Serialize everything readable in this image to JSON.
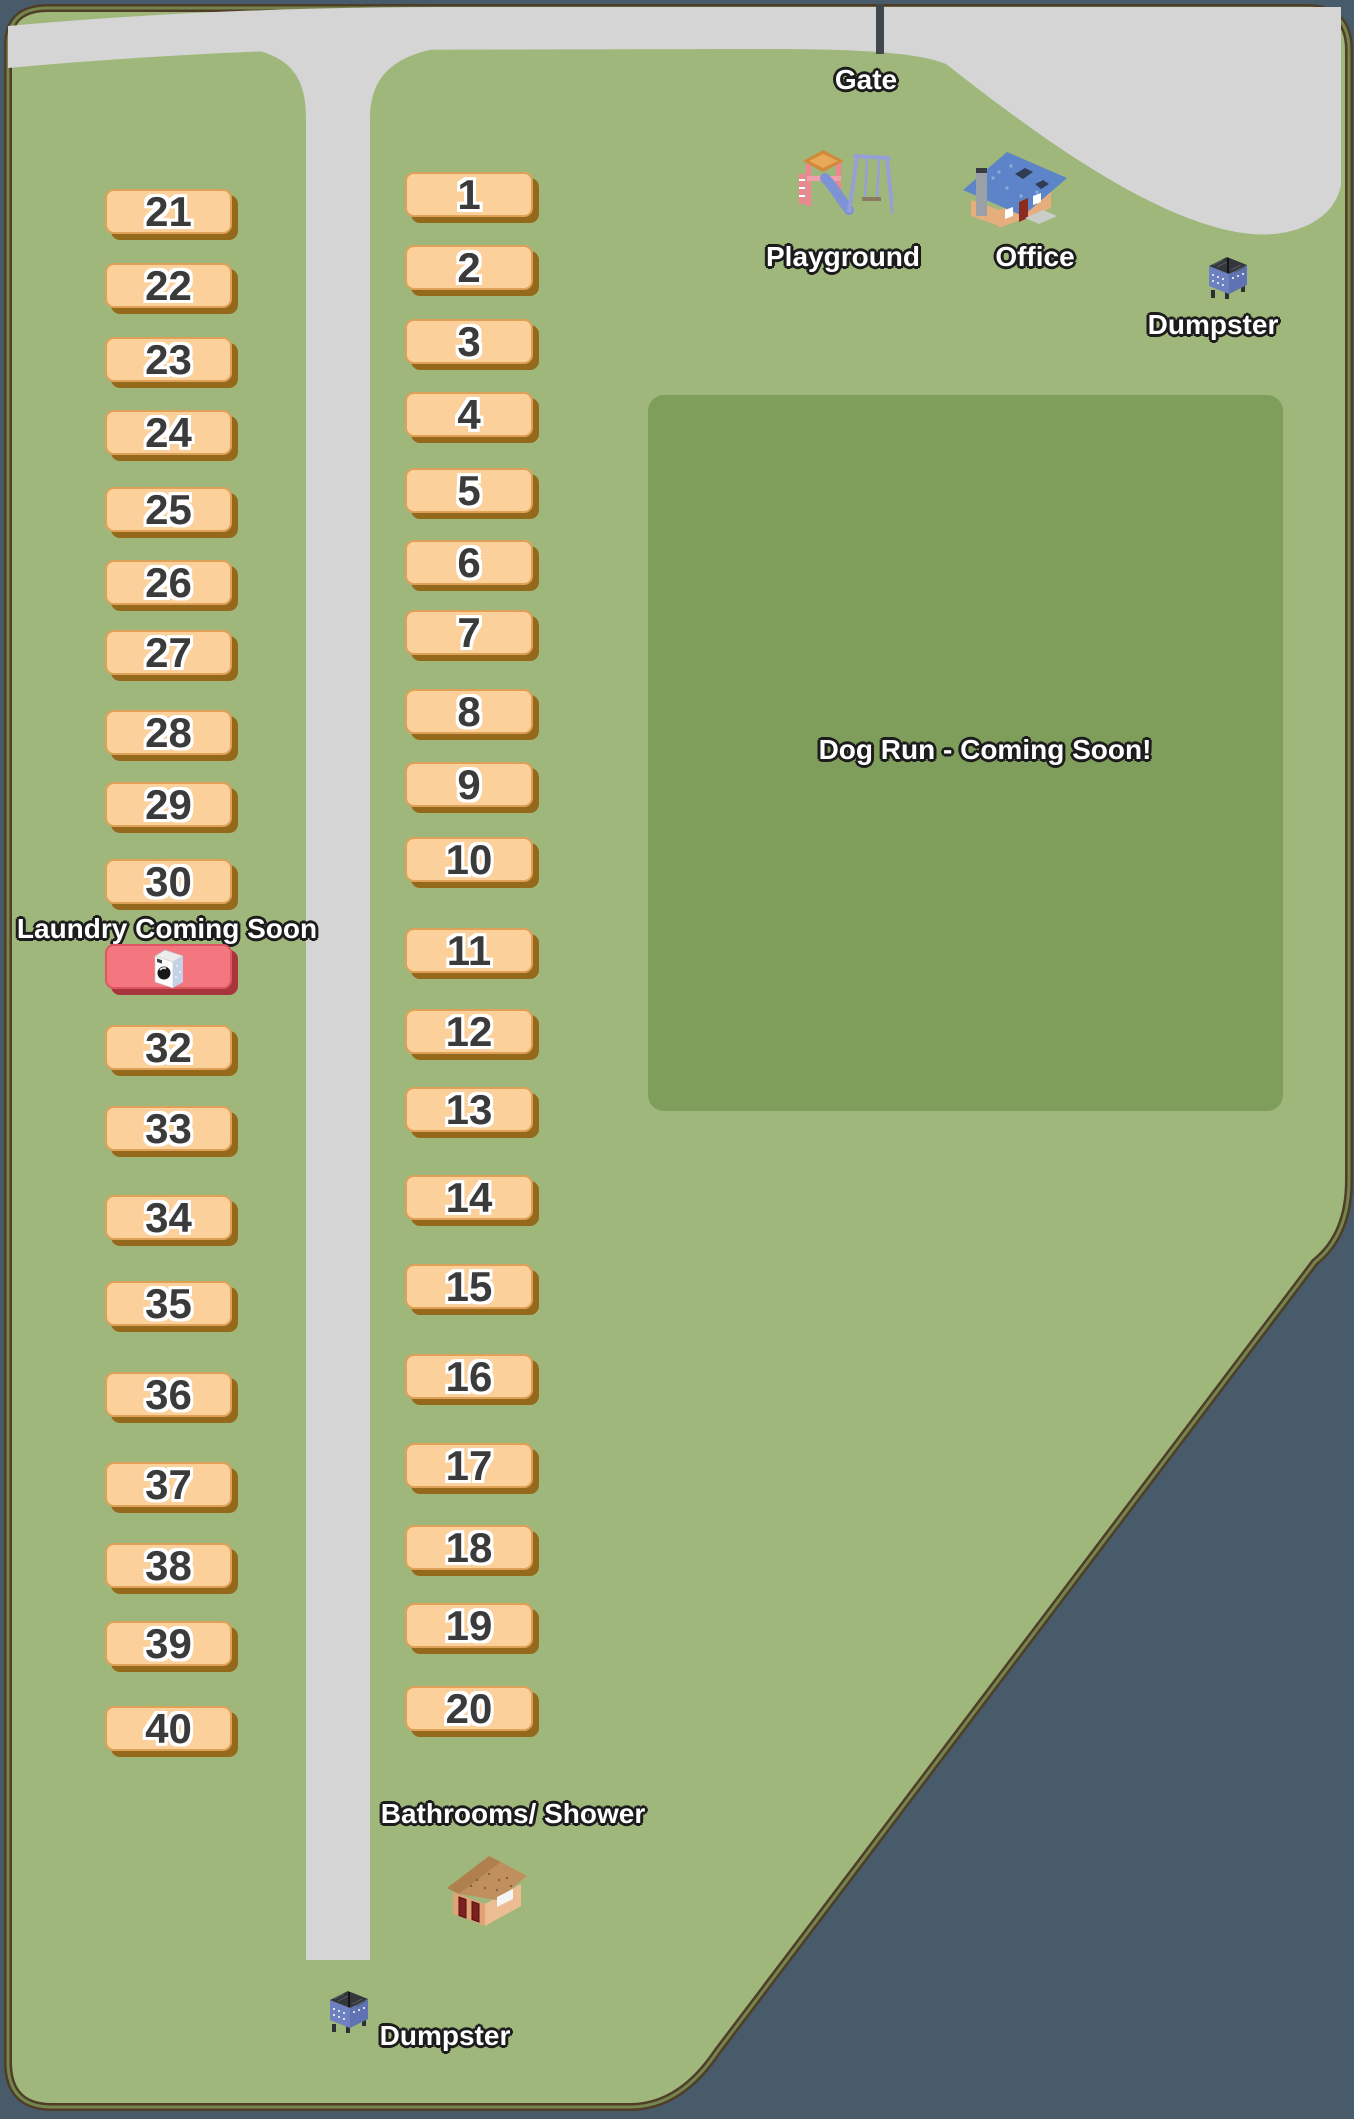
{
  "map_labels": {
    "gate": "Gate",
    "playground": "Playground",
    "office": "Office",
    "dumpster_top": "Dumpster",
    "dog_run": "Dog Run - Coming Soon!",
    "laundry": "Laundry Coming Soon",
    "bathrooms": "Bathrooms/ Shower",
    "dumpster_bottom": "Dumpster"
  },
  "sites": {
    "box": {
      "left_x": 105,
      "left_w": 127,
      "middle_x": 405,
      "middle_w": 128,
      "h": 45
    },
    "left_column": [
      {
        "label": "21",
        "y": 189
      },
      {
        "label": "22",
        "y": 263
      },
      {
        "label": "23",
        "y": 337
      },
      {
        "label": "24",
        "y": 410
      },
      {
        "label": "25",
        "y": 487
      },
      {
        "label": "26",
        "y": 560
      },
      {
        "label": "27",
        "y": 630
      },
      {
        "label": "28",
        "y": 710
      },
      {
        "label": "29",
        "y": 782
      },
      {
        "label": "30",
        "y": 859
      },
      {
        "label": "32",
        "y": 1025
      },
      {
        "label": "33",
        "y": 1106
      },
      {
        "label": "34",
        "y": 1195
      },
      {
        "label": "35",
        "y": 1281
      },
      {
        "label": "36",
        "y": 1372
      },
      {
        "label": "37",
        "y": 1462
      },
      {
        "label": "38",
        "y": 1543
      },
      {
        "label": "39",
        "y": 1621
      },
      {
        "label": "40",
        "y": 1706
      }
    ],
    "middle_column": [
      {
        "label": "1",
        "y": 172
      },
      {
        "label": "2",
        "y": 245
      },
      {
        "label": "3",
        "y": 319
      },
      {
        "label": "4",
        "y": 392
      },
      {
        "label": "5",
        "y": 468
      },
      {
        "label": "6",
        "y": 540
      },
      {
        "label": "7",
        "y": 610
      },
      {
        "label": "8",
        "y": 689
      },
      {
        "label": "9",
        "y": 762
      },
      {
        "label": "10",
        "y": 837
      },
      {
        "label": "11",
        "y": 928
      },
      {
        "label": "12",
        "y": 1009
      },
      {
        "label": "13",
        "y": 1087
      },
      {
        "label": "14",
        "y": 1175
      },
      {
        "label": "15",
        "y": 1264
      },
      {
        "label": "16",
        "y": 1354
      },
      {
        "label": "17",
        "y": 1443
      },
      {
        "label": "18",
        "y": 1525
      },
      {
        "label": "19",
        "y": 1603
      },
      {
        "label": "20",
        "y": 1686
      }
    ]
  },
  "laundry_box": {
    "x": 105,
    "y": 944,
    "w": 127,
    "h": 45
  },
  "colors": {
    "background": "#475b6b",
    "park": "#a0b77c",
    "dog_run": "#7f9e5b",
    "road": "#d5d5d5",
    "site_fill": "#fbd09a",
    "site_border": "#dfa057",
    "site_shadow": "#94691c",
    "site_number": "#3b3b3b",
    "laundry_fill": "#f4767e",
    "laundry_shadow": "#a8343c",
    "label_text": "#ffffff",
    "label_outline": "#1c1c1c",
    "border_brown": "#4f3d27",
    "border_olive": "#74854d",
    "gate": "#42474b"
  }
}
